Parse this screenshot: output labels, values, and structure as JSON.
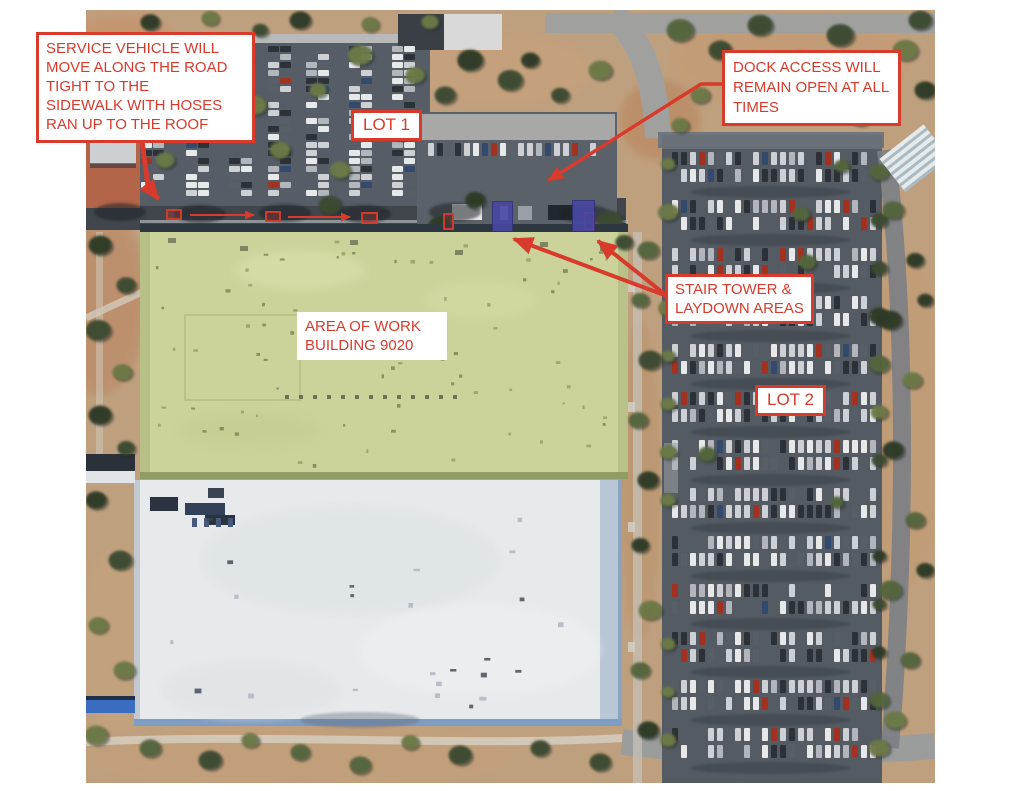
{
  "annotations": {
    "service_note": {
      "text": "SERVICE VEHICLE WILL\nMOVE ALONG THE ROAD\nTIGHT TO THE\nSIDEWALK WITH HOSES\nRAN UP TO THE ROOF"
    },
    "lot1_label": {
      "text": "LOT 1"
    },
    "dock_note": {
      "text": "DOCK ACCESS WILL\nREMAIN OPEN AT ALL\nTIMES"
    },
    "stair_note": {
      "text": "STAIR TOWER &\nLAYDOWN AREAS"
    },
    "work_area_note": {
      "text": "AREA OF WORK\nBUILDING 9020"
    },
    "lot2_label": {
      "text": "LOT 2"
    }
  },
  "markers": {
    "service_vehicle_positions": 3,
    "dock_access_positions": 2,
    "stair_tower_laydown_areas": 2
  },
  "colors": {
    "annotation_red": "#d83a2c",
    "stair_tower_blue": "#4747a3",
    "work_area_roof_green": "#cbd39b"
  }
}
